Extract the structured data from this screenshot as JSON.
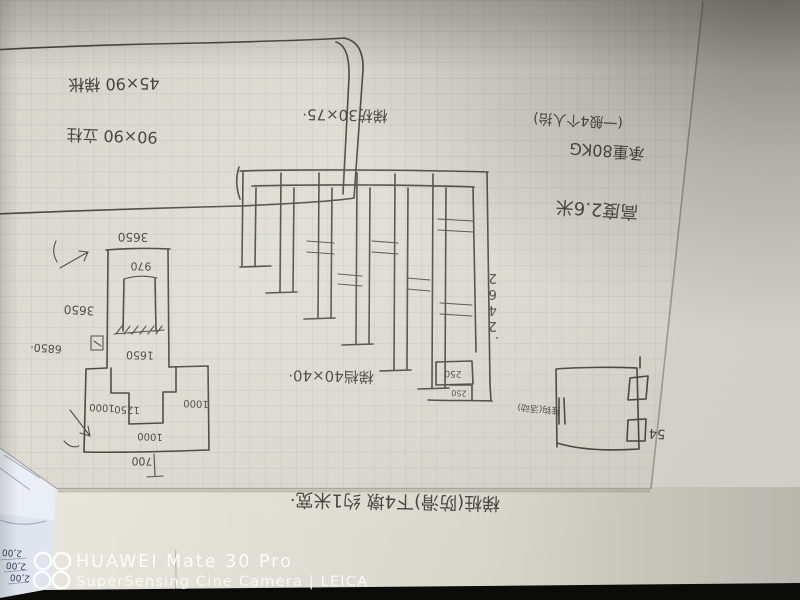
{
  "colors": {
    "ink": "#44403a",
    "paper": "#dad7cf",
    "grid_line": "#aeb5af",
    "corner_shadow": "#34302c",
    "under_paper": "#e9e6dd",
    "blue_paper": "#dfe4ee",
    "black_bar": "#0b0b0a",
    "watermark_white": "#fbfbf8"
  },
  "notes": {
    "size_note_1": "45×90 梯枨",
    "size_note_2": "90×90 立柱",
    "stringer_note": "梯枋30×75·",
    "carry_note": "(一般4个人抬)",
    "load_note": "承重80KG",
    "height_note": "高度2.6米",
    "rung_note": "梯档40×40·",
    "bottom_note": "梯桩(防滑)下4墩 约1米宽·"
  },
  "left_drawing": {
    "top_width": "3650",
    "neck_width": "970",
    "side_height": "3650",
    "overall_height": "6850·",
    "inner_height": "1650",
    "left_offset": "1000",
    "pedestal_width": "1250",
    "right_offset": "1000",
    "base_inner": "1000",
    "base_offset": "700"
  },
  "stair_drawing": {
    "height_dim": "2642·",
    "step_dim_a": "250",
    "step_dim_b": "250"
  },
  "hook_drawing": {
    "caption": "挂钩(活动)",
    "tag": "54"
  },
  "side_paper": {
    "rows": [
      "2,00",
      "2,00",
      "2,00"
    ]
  },
  "watermark": {
    "device": "HUAWEI Mate 30 Pro",
    "camera": "SuperSensing Cine Camera | LEICA"
  }
}
